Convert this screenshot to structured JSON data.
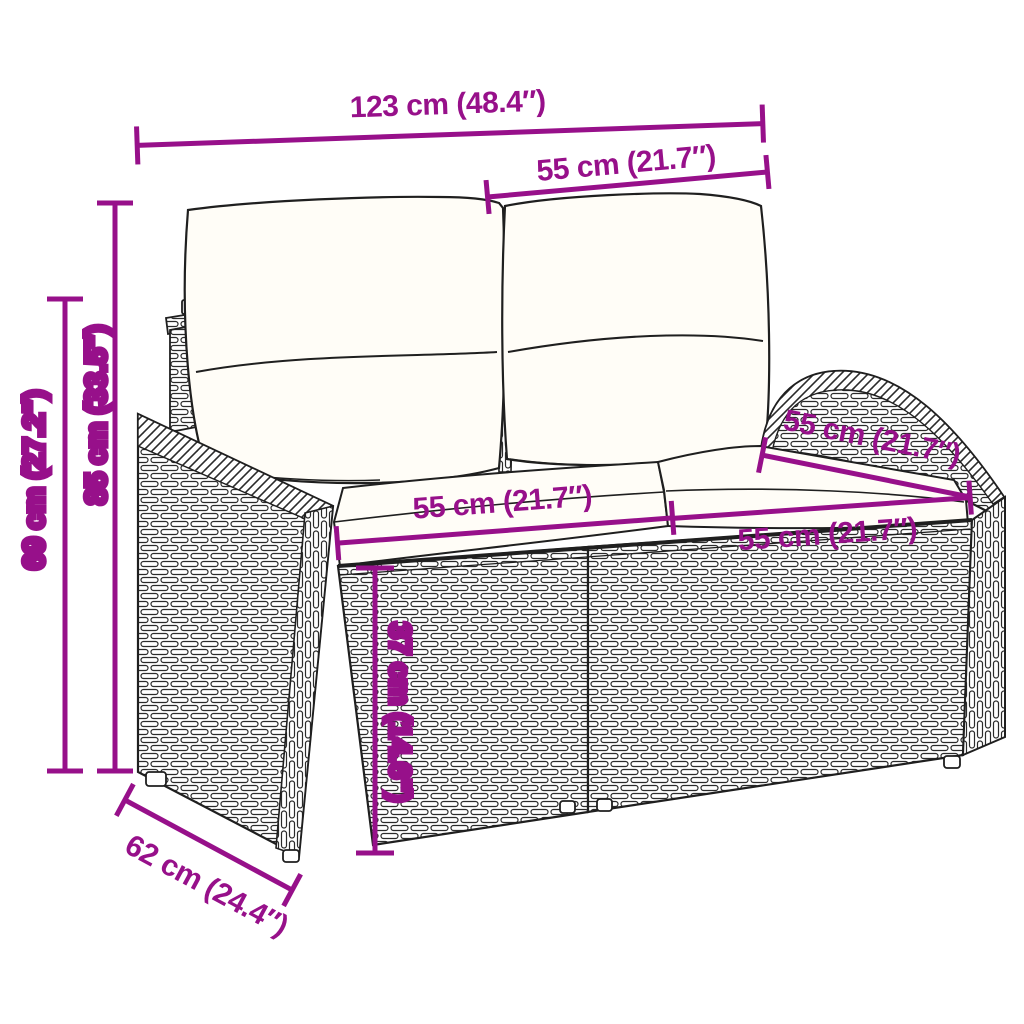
{
  "diagram": {
    "kind": "product-dimension-line-drawing",
    "subject": "poly rattan 2-seater garden sofa with two back pillows and two seat cushions",
    "accent_color": "#97108a",
    "outline_color": "#1f1f1f",
    "cushion_color": "#fffdf7",
    "background_color": "#ffffff",
    "dimensions": [
      {
        "id": "overall-width",
        "label": "123 cm (48.4″)",
        "orientation": "horizontal-top"
      },
      {
        "id": "back-pillow-width",
        "label": "55 cm (21.7″)",
        "orientation": "horizontal-top-right"
      },
      {
        "id": "overall-height",
        "label": "85 cm (33.5″)",
        "orientation": "vertical-left-inner"
      },
      {
        "id": "armrest-height",
        "label": "69 cm (27.2″)",
        "orientation": "vertical-left-outer"
      },
      {
        "id": "seat-width-left",
        "label": "55 cm (21.7″)",
        "orientation": "horizontal-left-seat"
      },
      {
        "id": "seat-width-right",
        "label": "55 cm (21.7″)",
        "orientation": "horizontal-right-seat"
      },
      {
        "id": "seat-depth",
        "label": "55 cm (21.7″)",
        "orientation": "diagonal-right"
      },
      {
        "id": "seat-height",
        "label": "37 cm (14.6″)",
        "orientation": "vertical-front"
      },
      {
        "id": "overall-depth",
        "label": "62 cm (24.4″)",
        "orientation": "diagonal-bottom-left"
      }
    ]
  }
}
